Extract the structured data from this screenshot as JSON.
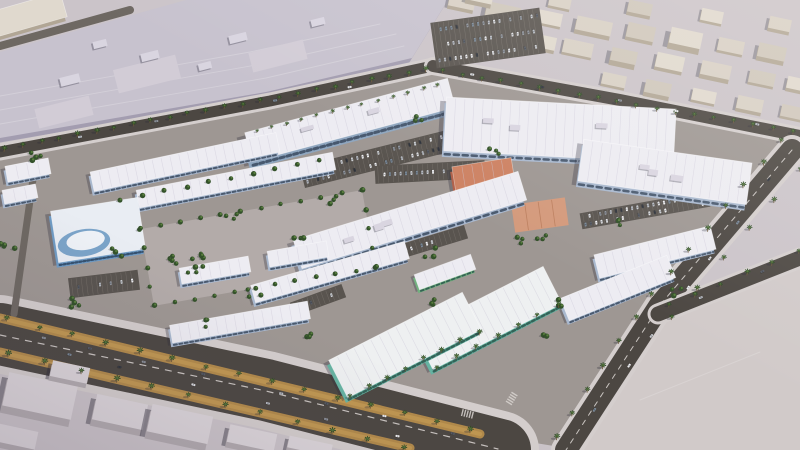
{
  "meta": {
    "description": "Aerial 3D architectural rendering of a master-planned retail commercial district with white strip-mall buildings, teal and terracotta accent buildings, palm-lined boulevards, parking lots and surrounding low-rise city blocks",
    "width": 800,
    "height": 450
  },
  "palette": {
    "ground": "#cbc4c9",
    "complexGround": "#9e9793",
    "ringGround": "#b3aba9",
    "road": "#4c4742",
    "roadMid": "#6e6862",
    "sidewalk": "#d4cecd",
    "lane": "#c9c4c0",
    "parking": "#59544f",
    "stall": "#8d8781",
    "gold": "#b28a4a",
    "goldLight": "#c9a057",
    "bigRoof": "#c7c2ce",
    "bigRoofPatch": "#d2ccd6",
    "roofUnit": "#d9d5e0",
    "bigRoofWall": "#a39db0",
    "whiteRoof": "#edecf2",
    "roofLine": "#cdcad8",
    "wallBlue": "#a9b8ce",
    "glass": "#3f5065",
    "twoWall": "#8fa6bf",
    "tealWall": "#66b3a2",
    "tealGlass": "#2d5a50",
    "tealRoof": "#eef0f1",
    "greenWall": "#72b07f",
    "salmonRoof": "#cd8263",
    "salmonWall": "#b06049",
    "plazaFill": "#d49a7c",
    "plazaLine": "#bc7f5f",
    "showGlass": "#6f9bc4",
    "showRoof": "#e9edf3",
    "ctxColors": [
      "#d8d0c5",
      "#cfc7bb",
      "#e0d9ce"
    ],
    "ctxWall": "#b1a695",
    "fgRoof": "#dcd6da",
    "fgWall": "#b2abaf",
    "parcel": "#d1cac9",
    "parcelLine": "#e0dad8",
    "palm": "#2f4d26",
    "palmLite": "#527538",
    "trunk": "#6d5839",
    "tree": "#33512a",
    "treeLite": "#587e3d",
    "shadow": "rgba(45,42,60,0.32)",
    "carColors": [
      "#f4f4f6",
      "#e2e3e6",
      "#b9bdc4",
      "#8f949c",
      "#565b64",
      "#33373e",
      "#cdd0d4",
      "#7b8a99"
    ]
  },
  "scene": {
    "seed": 13,
    "complexGround": [
      [
        0,
        155
      ],
      [
        270,
        104
      ],
      [
        433,
        70
      ],
      [
        620,
        104
      ],
      [
        795,
        140
      ],
      [
        660,
        305
      ],
      [
        566,
        448
      ],
      [
        480,
        434
      ],
      [
        0,
        318
      ]
    ],
    "bigRoof": {
      "poly": [
        [
          0,
          138
        ],
        [
          266,
          92
        ],
        [
          412,
          58
        ],
        [
          448,
          0
        ],
        [
          186,
          0
        ],
        [
          0,
          52
        ]
      ],
      "patches": [
        [
          115,
          62,
          64,
          24
        ],
        [
          250,
          46,
          56,
          20
        ],
        [
          36,
          102,
          56,
          20
        ]
      ],
      "units": [
        [
          70,
          80,
          20,
          9
        ],
        [
          150,
          56,
          18,
          8
        ],
        [
          238,
          38,
          18,
          8
        ],
        [
          318,
          22,
          14,
          7
        ],
        [
          100,
          44,
          14,
          7
        ],
        [
          205,
          66,
          13,
          7
        ]
      ],
      "rot": -14,
      "seams": [
        [
          [
            0,
            124
          ],
          [
            266,
            78
          ],
          [
            404,
            46
          ]
        ],
        [
          [
            0,
            110
          ],
          [
            262,
            64
          ],
          [
            396,
            34
          ]
        ],
        [
          [
            0,
            96
          ],
          [
            250,
            52
          ],
          [
            380,
            24
          ]
        ]
      ]
    },
    "parcel": {
      "poly": [
        [
          574,
          450
        ],
        [
          664,
          322
        ],
        [
          800,
          266
        ],
        [
          800,
          450
        ]
      ],
      "curb": [
        [
          574,
          450
        ],
        [
          664,
          322
        ],
        [
          800,
          266
        ]
      ]
    },
    "roads": [
      {
        "p": [
          [
            0,
            46
          ],
          [
            130,
            10
          ]
        ],
        "w": 8,
        "c": "roadMid"
      },
      {
        "p": [
          [
            0,
            152
          ],
          [
            270,
            101
          ],
          [
            433,
            66
          ]
        ],
        "w": 11,
        "c": "road",
        "u": 17
      },
      {
        "p": [
          [
            433,
            66
          ],
          [
            620,
            100
          ],
          [
            800,
            136
          ]
        ],
        "w": 12,
        "c": "road",
        "u": 18
      },
      {
        "p": [
          [
            792,
            150
          ],
          [
            660,
            305
          ],
          [
            566,
            450
          ]
        ],
        "w": 22,
        "c": "road",
        "u": 30,
        "dash": true
      },
      {
        "p": [
          [
            658,
            314
          ],
          [
            800,
            258
          ]
        ],
        "w": 15,
        "c": "road",
        "u": 21
      },
      {
        "p": [
          [
            0,
            334
          ],
          [
            266,
            390
          ],
          [
            500,
            450
          ]
        ],
        "w": 62,
        "c": "road",
        "u": 78
      },
      {
        "p": [
          [
            36,
            158
          ],
          [
            14,
            314
          ]
        ],
        "w": 7,
        "c": "roadMid"
      }
    ],
    "goldStrips": [
      {
        "p": [
          [
            0,
            318
          ],
          [
            480,
            434
          ]
        ],
        "w": 9
      },
      {
        "p": [
          [
            0,
            352
          ],
          [
            410,
            448
          ]
        ],
        "w": 9
      }
    ],
    "laneDashes": [
      {
        "p": [
          [
            0,
            335
          ],
          [
            266,
            391
          ],
          [
            498,
            449
          ]
        ]
      }
    ],
    "contextBlocks": [
      [
        462,
        2,
        26,
        12,
        4,
        0
      ],
      [
        503,
        12,
        34,
        15,
        6,
        1
      ],
      [
        549,
        18,
        26,
        13,
        3,
        2
      ],
      [
        594,
        26,
        36,
        14,
        5,
        0
      ],
      [
        641,
        32,
        28,
        15,
        4,
        1
      ],
      [
        686,
        38,
        32,
        16,
        7,
        2
      ],
      [
        731,
        46,
        26,
        13,
        3,
        0
      ],
      [
        772,
        52,
        28,
        14,
        5,
        1
      ],
      [
        544,
        42,
        24,
        13,
        4,
        2
      ],
      [
        578,
        48,
        30,
        14,
        3,
        0
      ],
      [
        624,
        56,
        26,
        13,
        6,
        1
      ],
      [
        670,
        62,
        28,
        15,
        4,
        2
      ],
      [
        716,
        70,
        30,
        14,
        5,
        0
      ],
      [
        762,
        78,
        26,
        13,
        3,
        1
      ],
      [
        798,
        84,
        22,
        12,
        4,
        2
      ],
      [
        614,
        80,
        24,
        12,
        3,
        0
      ],
      [
        658,
        88,
        26,
        13,
        5,
        1
      ],
      [
        704,
        96,
        24,
        12,
        3,
        2
      ],
      [
        750,
        104,
        26,
        13,
        4,
        0
      ],
      [
        792,
        112,
        22,
        12,
        3,
        1
      ],
      [
        480,
        -4,
        26,
        12,
        5,
        2
      ],
      [
        560,
        2,
        22,
        11,
        3,
        0
      ],
      [
        640,
        8,
        24,
        12,
        4,
        1
      ],
      [
        712,
        16,
        22,
        12,
        3,
        2
      ],
      [
        780,
        24,
        22,
        12,
        4,
        0
      ]
    ],
    "contextRot": 12,
    "foregroundBlocks": [
      [
        40,
        396,
        70,
        34,
        8
      ],
      [
        120,
        412,
        52,
        26,
        7
      ],
      [
        14,
        436,
        46,
        18,
        6
      ],
      [
        180,
        424,
        62,
        28,
        8
      ],
      [
        252,
        438,
        48,
        18,
        6
      ],
      [
        70,
        372,
        38,
        16,
        5
      ],
      [
        310,
        446,
        44,
        12,
        5
      ]
    ],
    "foregroundRot": 12,
    "ring": {
      "x": 258,
      "y": 248,
      "w": 225,
      "h": 78,
      "rot": -10
    },
    "buildings": [
      [
        "two",
        350,
        120,
        210,
        30,
        -15
      ],
      [
        "strip",
        185,
        162,
        190,
        20,
        -12
      ],
      [
        "strip",
        236,
        180,
        200,
        18,
        -11
      ],
      [
        "anchor",
        560,
        130,
        230,
        54,
        3
      ],
      [
        "anchor",
        665,
        172,
        170,
        42,
        8
      ],
      [
        "anchor",
        410,
        220,
        235,
        30,
        -17
      ],
      [
        "strip",
        330,
        272,
        160,
        18,
        -16
      ],
      [
        "strip",
        240,
        322,
        140,
        18,
        -10
      ],
      [
        "strip",
        655,
        252,
        120,
        24,
        -14
      ],
      [
        "strip",
        618,
        288,
        115,
        24,
        -22
      ],
      [
        "teal",
        405,
        345,
        150,
        42,
        -27
      ],
      [
        "teal",
        488,
        318,
        145,
        42,
        -27
      ],
      [
        "green",
        445,
        272,
        60,
        16,
        -20
      ],
      [
        "salmon",
        484,
        178,
        60,
        32,
        -9
      ],
      [
        "plaza",
        540,
        215,
        54,
        28,
        -8
      ],
      [
        "showroom",
        98,
        230,
        88,
        52,
        -9
      ],
      [
        "strip",
        215,
        270,
        70,
        16,
        -10
      ],
      [
        "strip",
        298,
        254,
        60,
        16,
        -10
      ],
      [
        "strip",
        28,
        170,
        44,
        16,
        -11
      ],
      [
        "strip",
        20,
        194,
        34,
        14,
        -11
      ],
      [
        "ctx",
        30,
        14,
        70,
        26,
        -16
      ]
    ],
    "parkingLots": [
      [
        488,
        38,
        110,
        46,
        -8,
        3
      ],
      [
        380,
        158,
        160,
        22,
        -14,
        2
      ],
      [
        380,
        258,
        180,
        14,
        -17,
        1
      ],
      [
        645,
        210,
        130,
        16,
        -10,
        2
      ],
      [
        430,
        172,
        110,
        18,
        -3,
        1
      ],
      [
        318,
        300,
        55,
        14,
        -20,
        1
      ],
      [
        104,
        284,
        70,
        20,
        -7,
        1
      ]
    ],
    "palmRows": [
      {
        "p": [
          [
            4,
            149
          ],
          [
            426,
            70
          ]
        ],
        "n": 24,
        "s": 1
      },
      {
        "p": [
          [
            442,
            72
          ],
          [
            792,
            132
          ]
        ],
        "n": 19,
        "s": 1
      },
      {
        "p": [
          [
            256,
            132
          ],
          [
            438,
            85
          ]
        ],
        "n": 13,
        "s": 0.75
      },
      {
        "p": [
          [
            781,
            142
          ],
          [
            650,
            296
          ],
          [
            556,
            438
          ]
        ],
        "n": 14,
        "s": 1.05
      },
      {
        "p": [
          [
            800,
            170
          ],
          [
            672,
            318
          ]
        ],
        "n": 6,
        "s": 1
      },
      {
        "p": [
          [
            6,
            320
          ],
          [
            470,
            430
          ]
        ],
        "n": 15,
        "s": 1.1
      },
      {
        "p": [
          [
            8,
            354
          ],
          [
            404,
            448
          ]
        ],
        "n": 12,
        "s": 1.15
      },
      {
        "p": [
          [
            668,
            306
          ],
          [
            798,
            252
          ]
        ],
        "n": 6,
        "s": 1
      },
      {
        "p": [
          [
            350,
            396
          ],
          [
            478,
            332
          ]
        ],
        "n": 8,
        "s": 1
      },
      {
        "p": [
          [
            436,
            368
          ],
          [
            558,
            306
          ]
        ],
        "n": 7,
        "s": 0.95
      }
    ],
    "treeRows": [
      {
        "p": [
          [
            140,
            229
          ],
          [
            362,
            190
          ]
        ],
        "n": 12
      },
      {
        "p": [
          [
            362,
            190
          ],
          [
            376,
            267
          ]
        ],
        "n": 5
      },
      {
        "p": [
          [
            154,
            306
          ],
          [
            376,
            267
          ]
        ],
        "n": 12
      },
      {
        "p": [
          [
            140,
            229
          ],
          [
            154,
            306
          ]
        ],
        "n": 5
      },
      {
        "p": [
          [
            120,
            200
          ],
          [
            320,
            160
          ]
        ],
        "n": 10
      }
    ],
    "treeClusters": [
      [
        330,
        200,
        7,
        3
      ],
      [
        300,
        238,
        6,
        3
      ],
      [
        430,
        252,
        7,
        3
      ],
      [
        524,
        240,
        7,
        3
      ],
      [
        556,
        302,
        6,
        3
      ],
      [
        428,
        302,
        7,
        3
      ],
      [
        232,
        216,
        7,
        3
      ],
      [
        118,
        252,
        7,
        3
      ],
      [
        76,
        302,
        8,
        4
      ],
      [
        254,
        292,
        7,
        3
      ],
      [
        494,
        152,
        6,
        3
      ],
      [
        418,
        120,
        6,
        3
      ],
      [
        616,
        222,
        6,
        3
      ],
      [
        676,
        292,
        6,
        3
      ],
      [
        542,
        334,
        6,
        3
      ],
      [
        306,
        334,
        7,
        3
      ],
      [
        204,
        322,
        7,
        3
      ],
      [
        186,
        268,
        22,
        12
      ],
      [
        32,
        158,
        9,
        4
      ],
      [
        8,
        246,
        8,
        4
      ],
      [
        540,
        236,
        6,
        3
      ]
    ],
    "roadCars": [
      {
        "p": [
          [
            14,
            332
          ],
          [
            468,
            436
          ]
        ],
        "n": 8
      },
      {
        "p": [
          [
            30,
            346
          ],
          [
            430,
            444
          ]
        ],
        "n": 6
      },
      {
        "p": [
          [
            786,
            158
          ],
          [
            580,
            430
          ]
        ],
        "n": 7
      },
      {
        "p": [
          [
            446,
            70
          ],
          [
            786,
            130
          ]
        ],
        "n": 5
      },
      {
        "p": [
          [
            20,
            147
          ],
          [
            410,
            76
          ]
        ],
        "n": 4
      },
      {
        "p": [
          [
            672,
            308
          ],
          [
            790,
            260
          ]
        ],
        "n": 2
      }
    ],
    "crosswalks": [
      {
        "x": 512,
        "y": 398,
        "rot": -58,
        "n": 5
      },
      {
        "x": 468,
        "y": 414,
        "rot": 14,
        "n": 5
      }
    ]
  }
}
